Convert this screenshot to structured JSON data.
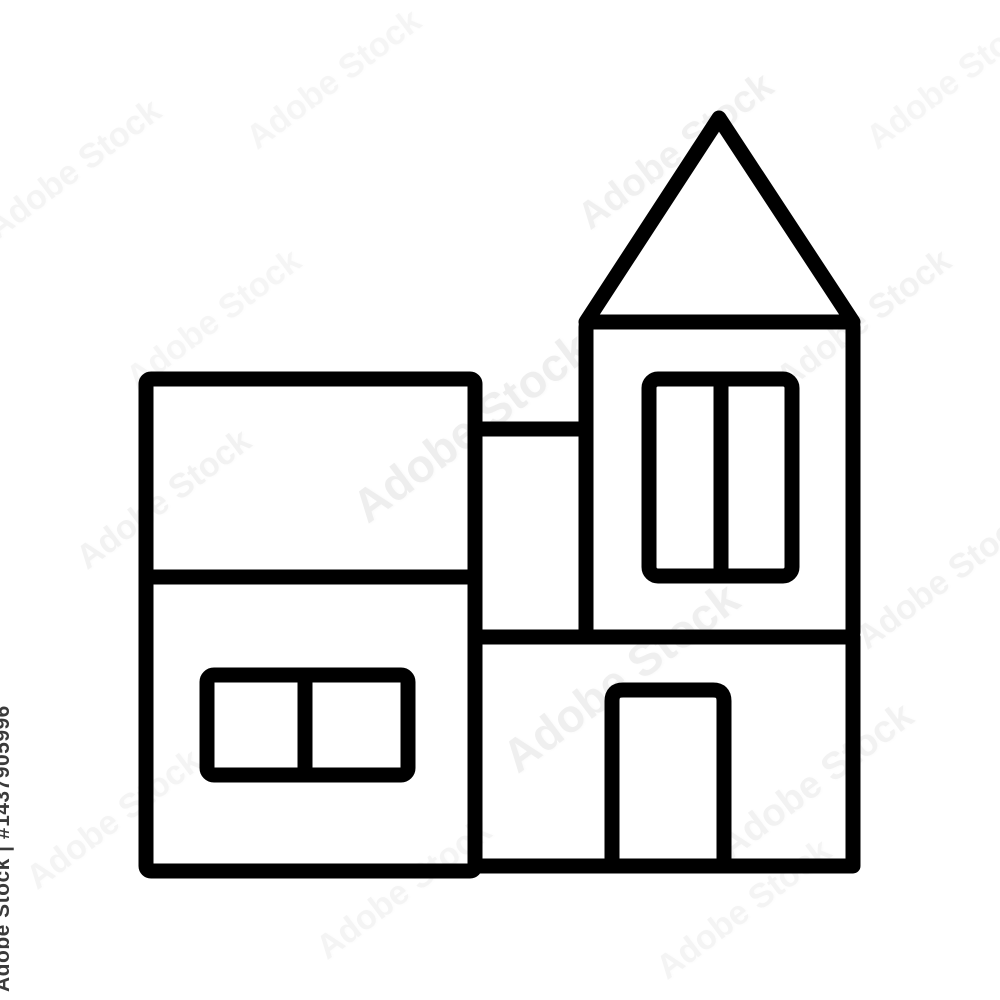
{
  "page": {
    "background_color": "#ffffff",
    "description": "Black outline icon of a modern two-storey house with a square tower and pitched tower roof, on a white background with Adobe Stock watermarking"
  },
  "icon": {
    "name": "house-with-tower-icon",
    "stroke_color": "#000000",
    "stroke_width": "15"
  },
  "watermark": {
    "tile_text": "Adobe Stock",
    "credit_text": "Adobe Stock | #1437905996",
    "asset_id": "1437905996",
    "tile_color": "#8a8a8a",
    "credit_color": "#3a3a3a"
  }
}
